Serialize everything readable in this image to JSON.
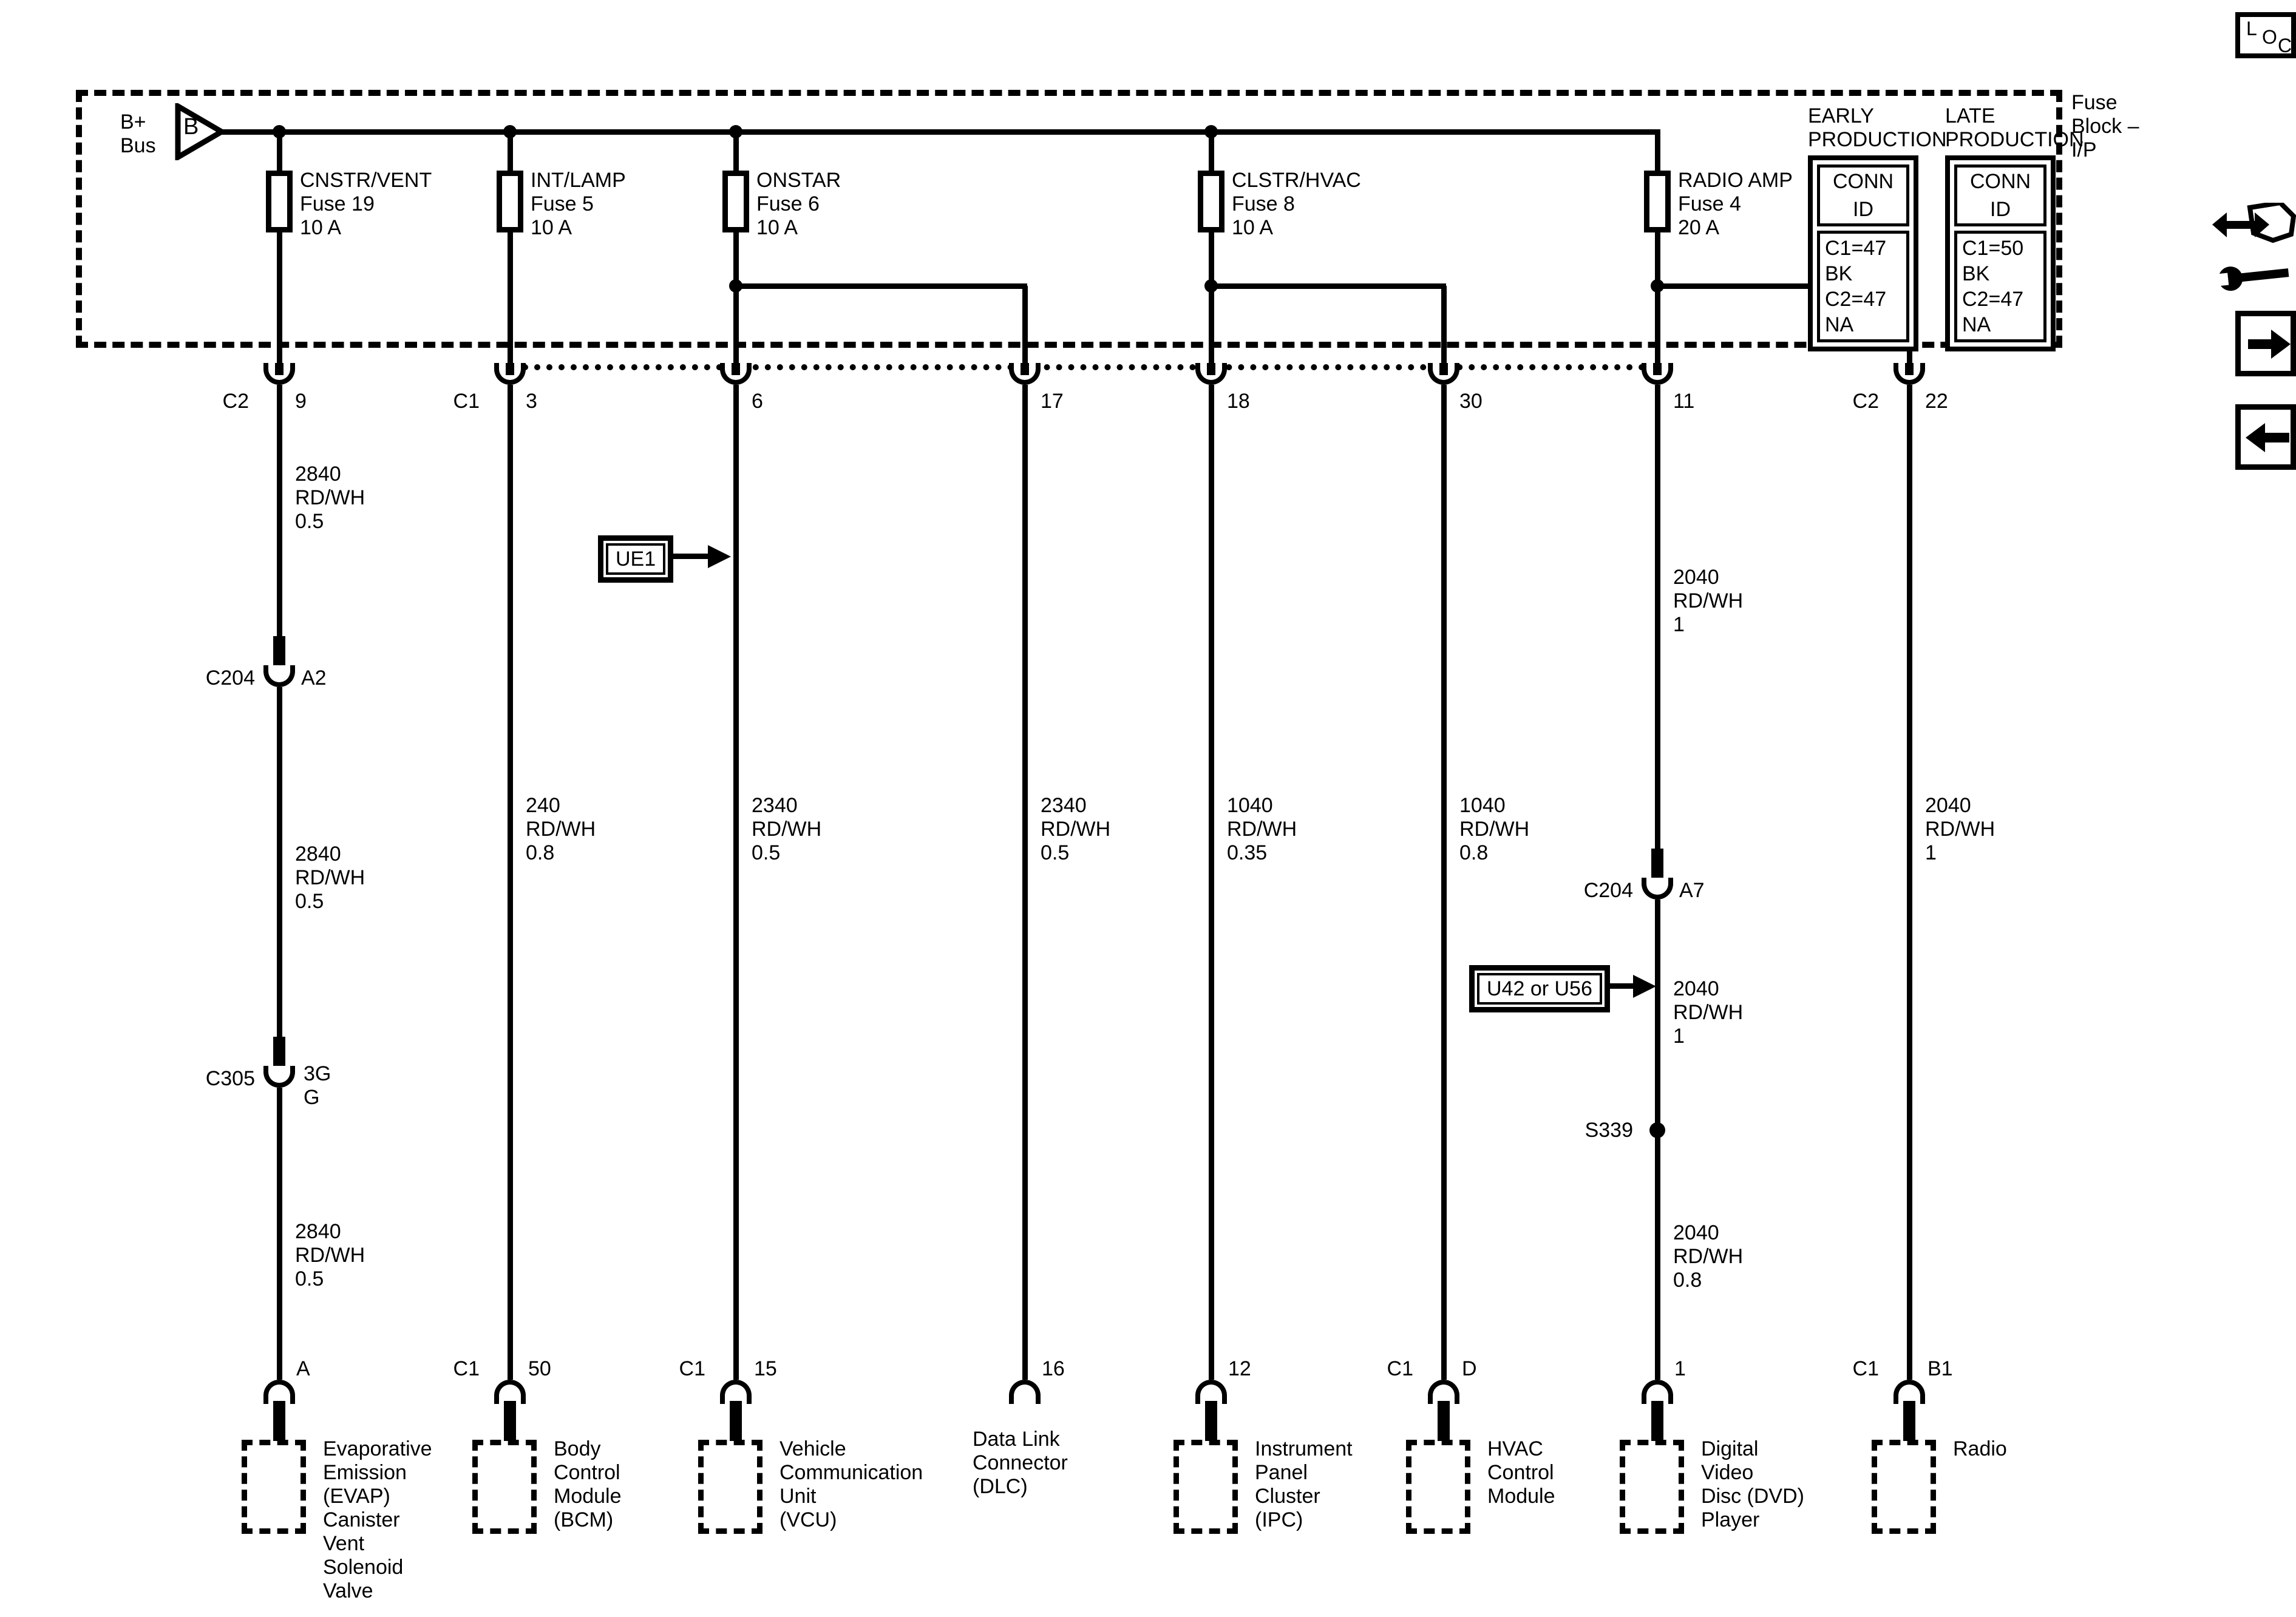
{
  "fuse_block": {
    "label": "Fuse\nBlock –\nI/P"
  },
  "bus": {
    "label": "B+\nBus",
    "letter": "B"
  },
  "production": {
    "early": {
      "title": "EARLY\nPRODUCTION",
      "header": "CONN ID",
      "ids": "C1=47 BK\nC2=47 NA"
    },
    "late": {
      "title": "LATE\nPRODUCTION",
      "header": "CONN ID",
      "ids": "C1=50 BK\nC2=47 NA"
    }
  },
  "callouts": {
    "ue1": "UE1",
    "u42_u56": "U42 or U56"
  },
  "icons": {
    "loc_l": "L",
    "loc_o": "O",
    "loc_c": "C"
  },
  "circuits": [
    {
      "top_conn": "C2",
      "top_pin": "9",
      "fuse": "CNSTR/VENT\nFuse 19\n10 A",
      "wire1": "2840\nRD/WH\n0.5",
      "conn1": "C204",
      "conn1_pin": "A2",
      "wire2": "2840\nRD/WH\n0.5",
      "conn2": "C305",
      "conn2_pin": "3G\nG",
      "wire3": "2840\nRD/WH\n0.5",
      "bottom_pin": "A",
      "module": "Evaporative\nEmission\n(EVAP)\nCanister\nVent\nSolenoid\nValve"
    },
    {
      "top_conn": "C1",
      "top_pin": "3",
      "fuse": "INT/LAMP\nFuse 5\n10 A",
      "wire1": "240\nRD/WH\n0.8",
      "bottom_conn": "C1",
      "bottom_pin": "50",
      "module": "Body\nControl\nModule\n(BCM)"
    },
    {
      "top_pin": "6",
      "fuse": "ONSTAR\nFuse 6\n10 A",
      "wire1": "2340\nRD/WH\n0.5",
      "bottom_conn": "C1",
      "bottom_pin": "15",
      "module": "Vehicle\nCommunication\nUnit\n(VCU)"
    },
    {
      "top_pin": "17",
      "wire1": "2340\nRD/WH\n0.5",
      "bottom_pin": "16",
      "module": "Data Link\nConnector\n(DLC)"
    },
    {
      "top_pin": "18",
      "fuse": "CLSTR/HVAC\nFuse 8\n10 A",
      "wire1": "1040\nRD/WH\n0.35",
      "bottom_pin": "12",
      "module": "Instrument\nPanel\nCluster\n(IPC)"
    },
    {
      "top_pin": "30",
      "wire1": "1040\nRD/WH\n0.8",
      "bottom_conn": "C1",
      "bottom_pin": "D",
      "module": "HVAC\nControl\nModule"
    },
    {
      "top_pin": "11",
      "fuse": "RADIO AMP\nFuse 4\n20 A",
      "wire1": "2040\nRD/WH\n1",
      "conn1": "C204",
      "conn1_pin": "A7",
      "wire2": "2040\nRD/WH\n1",
      "splice": "S339",
      "wire3": "2040\nRD/WH\n0.8",
      "bottom_pin": "1",
      "module": "Digital\nVideo\nDisc (DVD)\nPlayer"
    },
    {
      "top_conn": "C2",
      "top_pin": "22",
      "wire1": "2040\nRD/WH\n1",
      "bottom_conn": "C1",
      "bottom_pin": "B1",
      "module": "Radio"
    }
  ]
}
